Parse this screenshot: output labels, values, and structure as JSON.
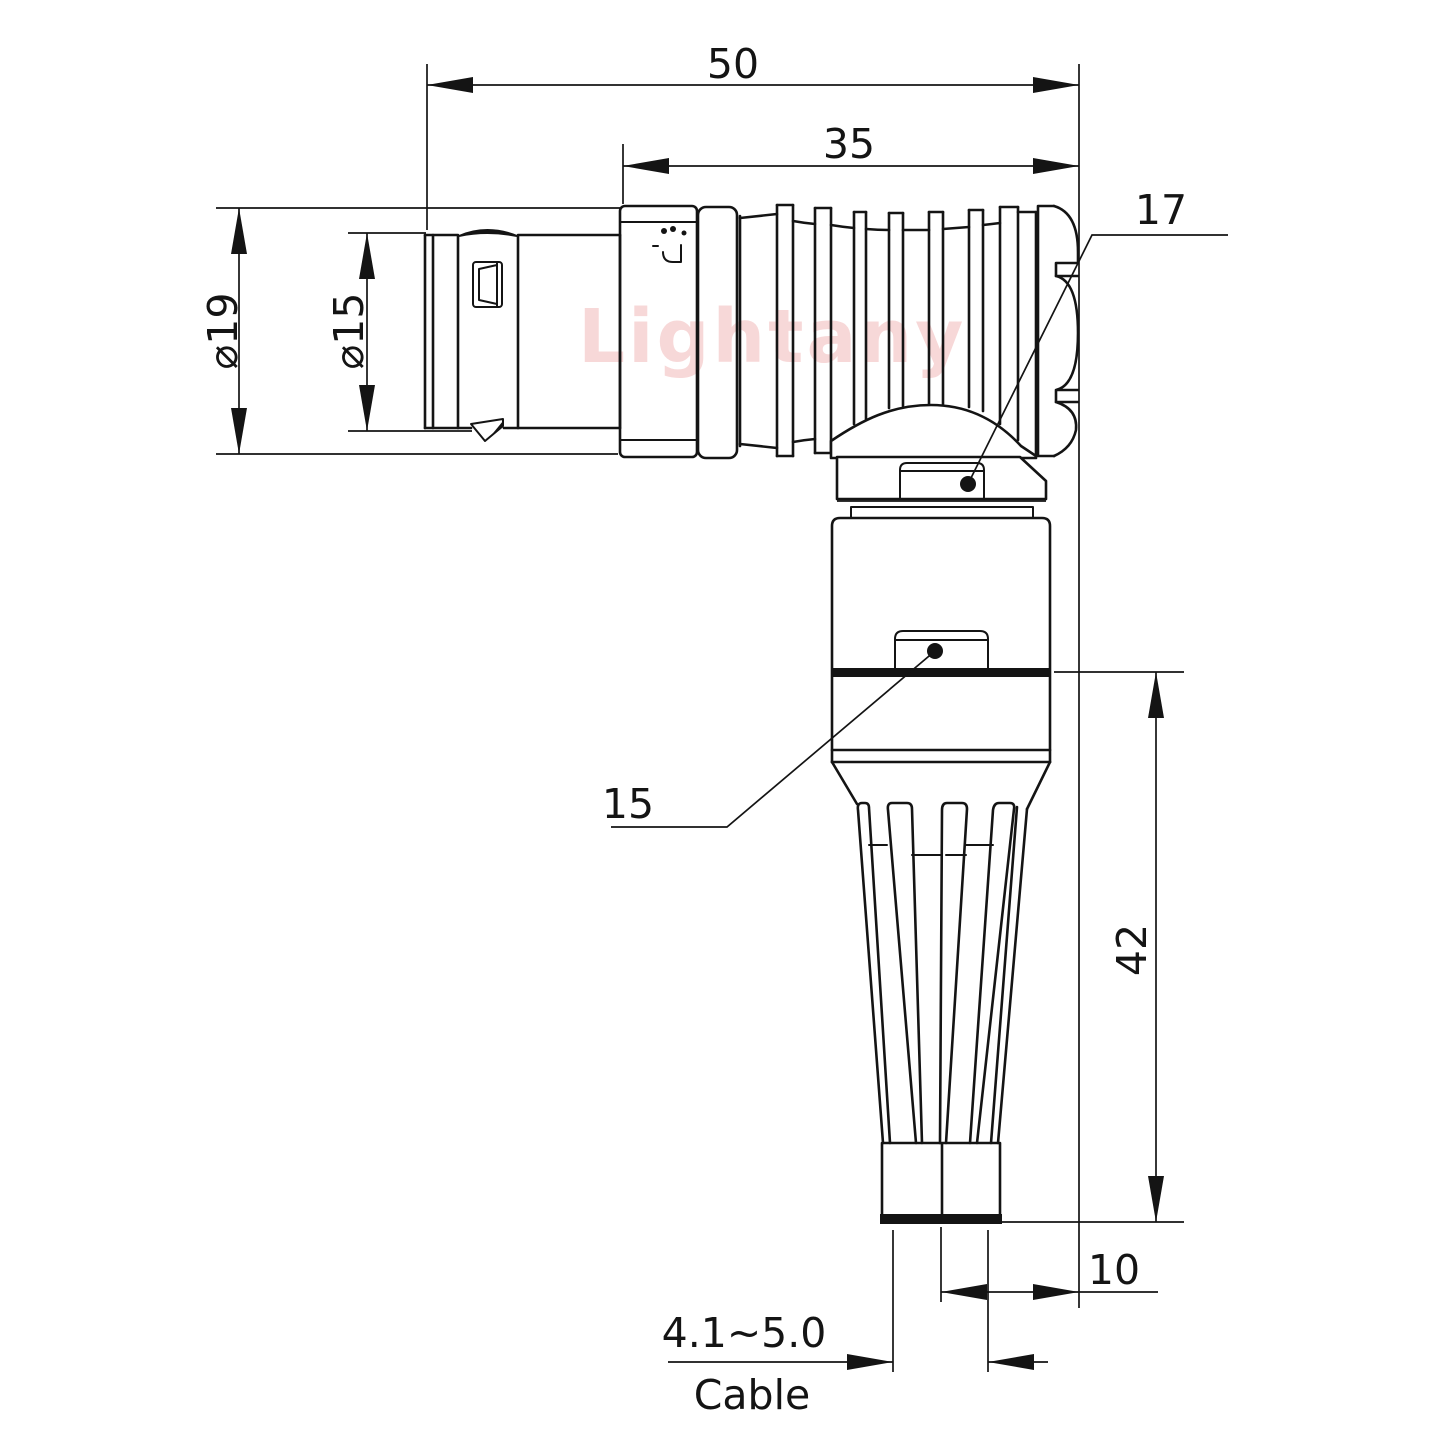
{
  "drawing": {
    "type": "right-angle cable connector, dimensioned engineering drawing",
    "watermark": "Lightany",
    "labels": {
      "overall_length": "50",
      "rear_length": "35",
      "shell_diameter": "⌀19",
      "front_diameter": "⌀15",
      "elbow_callout": "17",
      "body_callout": "15",
      "boot_length": "42",
      "exit_offset": "10",
      "cable_range": "4.1~5.0",
      "cable_word": "Cable"
    },
    "colors": {
      "line": "#141414",
      "background": "#ffffff",
      "watermark": "#f2b9b9",
      "callout_dot": "#000000"
    }
  }
}
